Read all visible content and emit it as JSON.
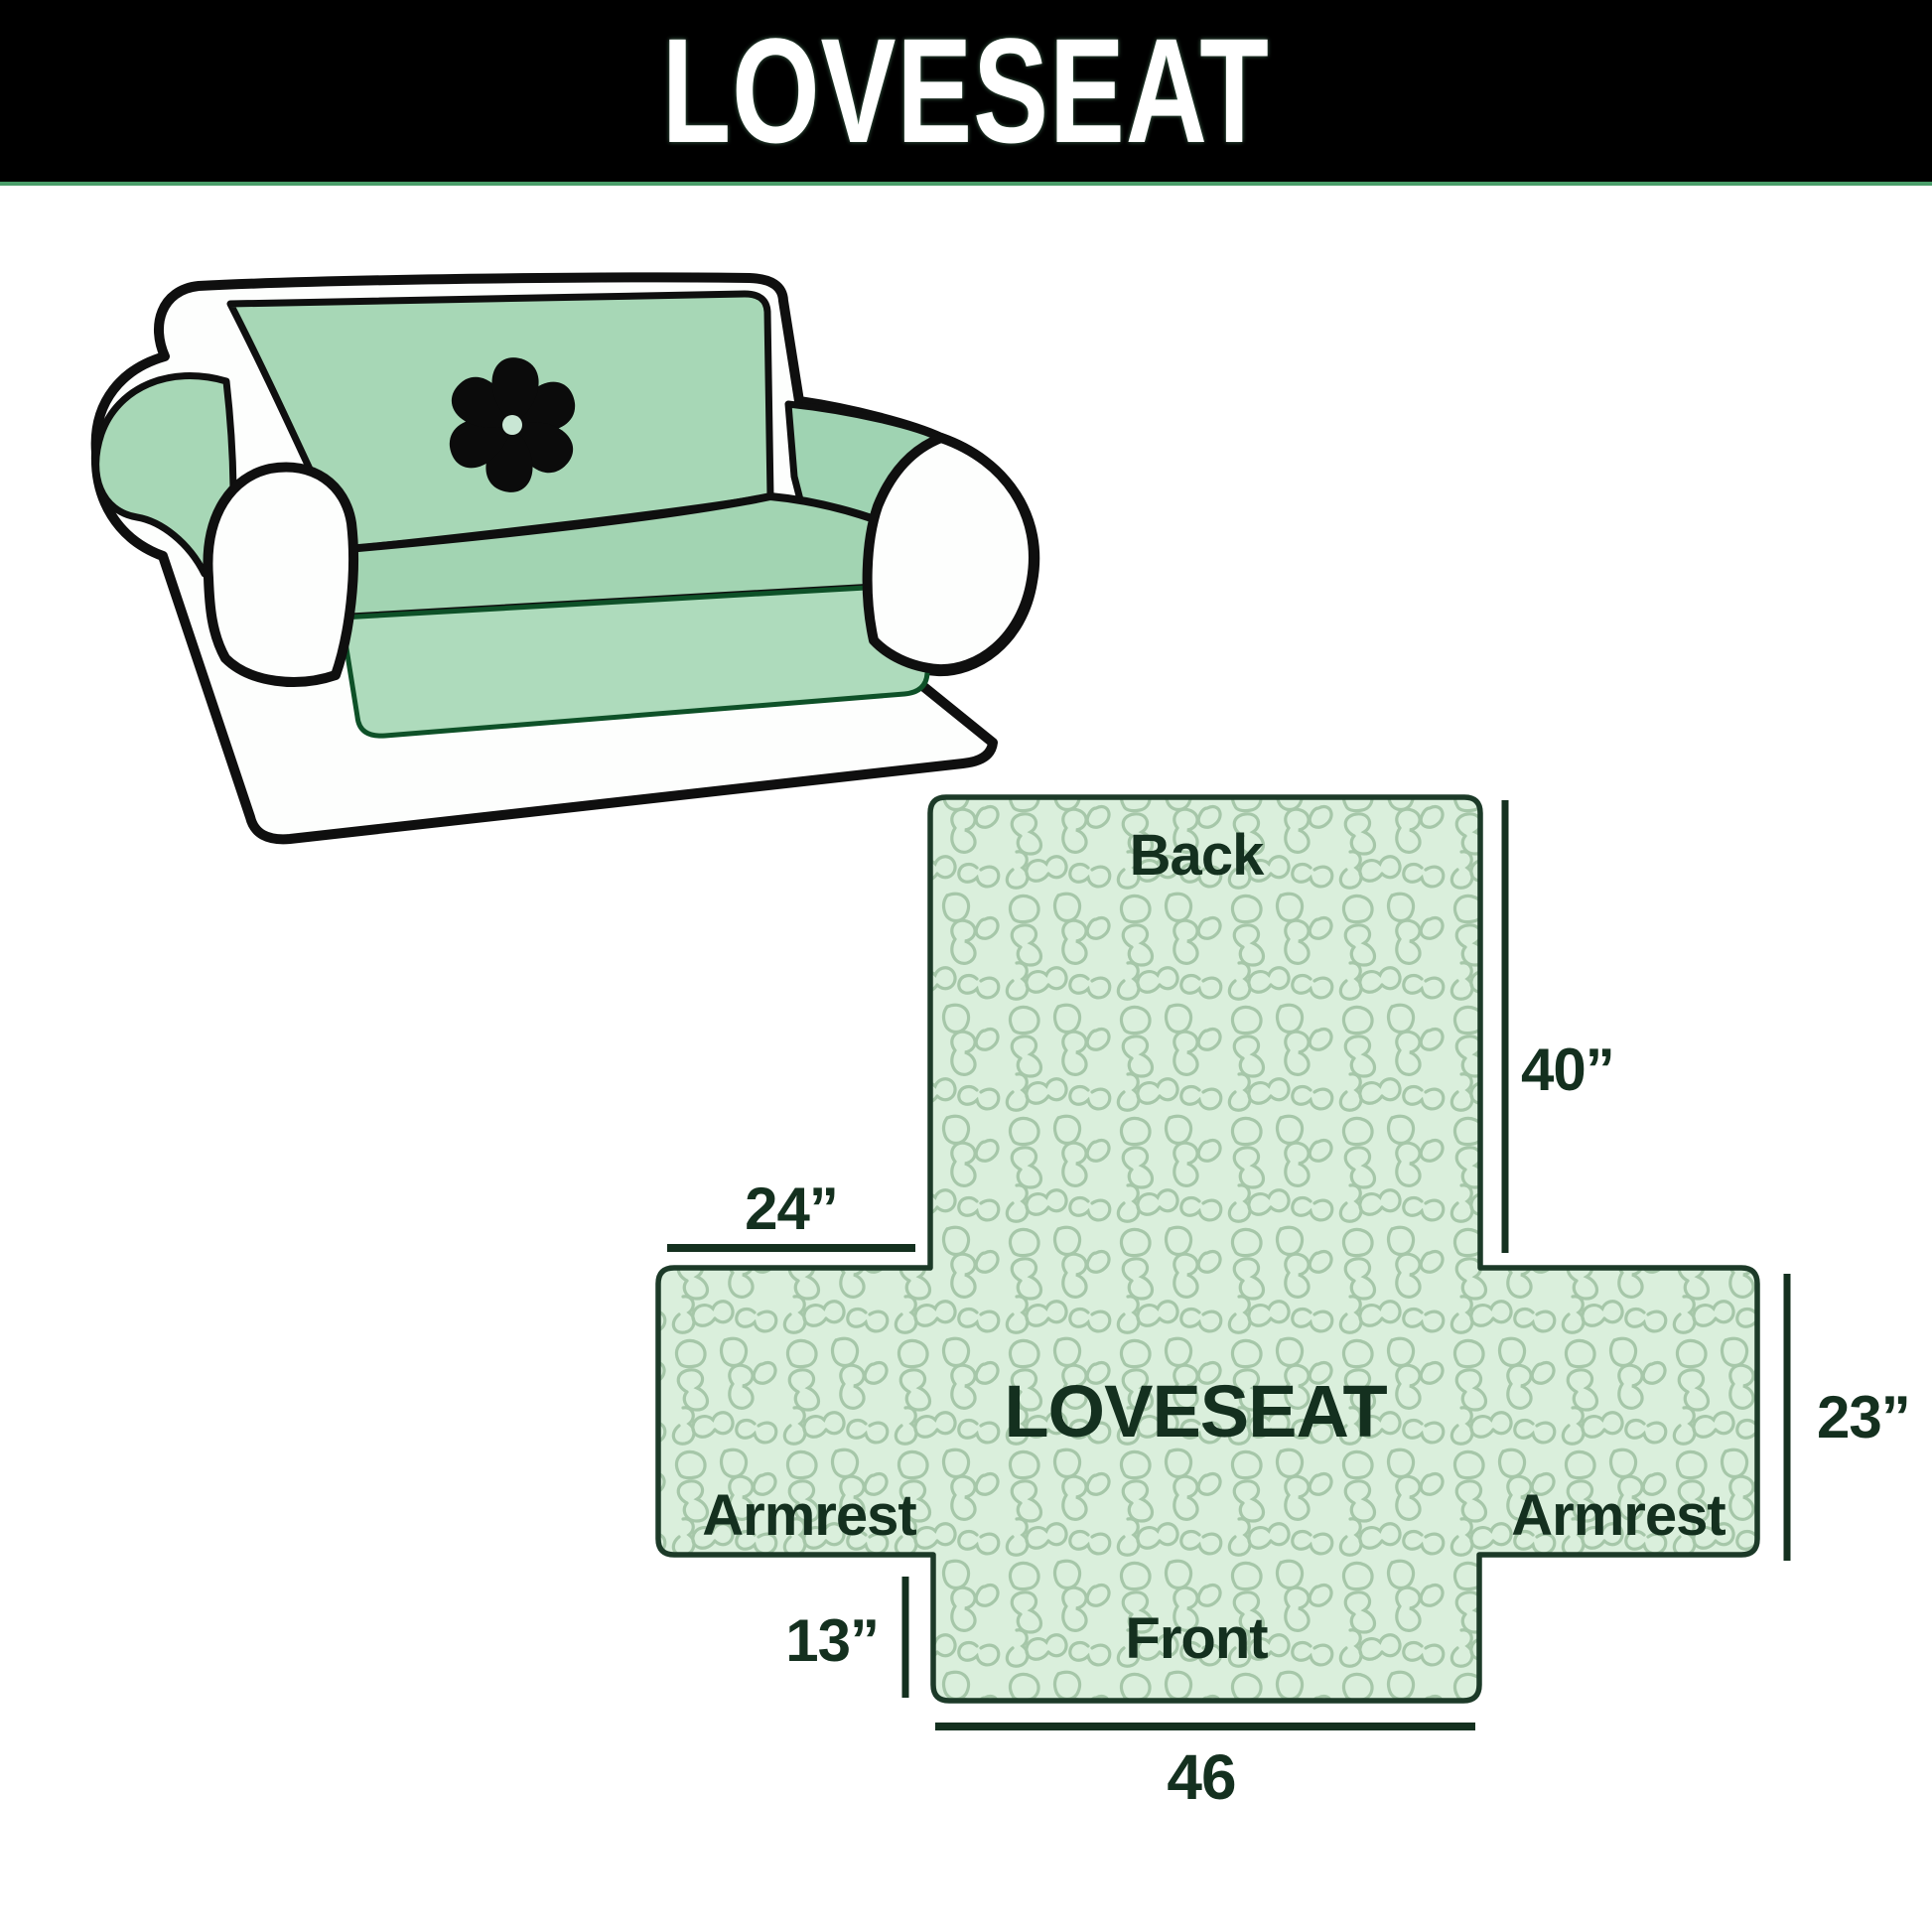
{
  "header": {
    "title": "LOVESEAT",
    "bg_color": "#000000",
    "text_color": "#ffffff",
    "underline_color": "#4a9e6a"
  },
  "illustration": {
    "name": "loveseat-sofa-with-slipcover",
    "cover_color": "#a7d7b6",
    "body_color": "#fdfefd",
    "outline_color": "#0f0f0f",
    "logo_icon": "pinwheel-icon",
    "logo_color": "#0b0b0b"
  },
  "diagram": {
    "shape": "cross-pattern-piece",
    "fill_color": "#daefdc",
    "squiggle_color": "#a6c7a9",
    "outline_color": "#1c3a28",
    "label_color": "#14301f",
    "product_label": "LOVESEAT",
    "labels": {
      "back": "Back",
      "front": "Front",
      "armrest_left": "Armrest",
      "armrest_right": "Armrest"
    },
    "dims": {
      "back_height": "40”",
      "armrest_top_width": "24”",
      "armrest_side_height": "23”",
      "front_drop": "13”",
      "front_width": "46"
    }
  }
}
